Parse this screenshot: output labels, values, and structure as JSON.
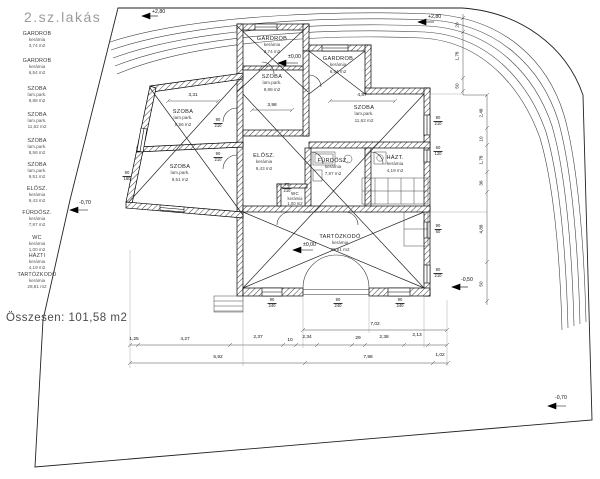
{
  "title": "2.sz.lakás",
  "total_label": "Összesen:  101,58 m2",
  "legend": [
    {
      "n": "GARDROB",
      "m": "kerámia",
      "a": "3,74  m2"
    },
    {
      "n": "GARDROB",
      "m": "kerámia",
      "a": "6,54  m2"
    },
    {
      "n": "SZOBA",
      "m": "lam.park.",
      "a": "9,88  m2"
    },
    {
      "n": "SZOBA",
      "m": "lam.park.",
      "a": "11,62  m2"
    },
    {
      "n": "SZOBA",
      "m": "lam.park.",
      "a": "8,56  m2"
    },
    {
      "n": "SZOBA",
      "m": "lam.park.",
      "a": "9,51  m2"
    },
    {
      "n": "ELŐSZ.",
      "m": "kerámia",
      "a": "9,43  m2"
    },
    {
      "n": "FÜRDŐSZ.",
      "m": "kerámia",
      "a": "7,87  m2"
    },
    {
      "n": "WC",
      "m": "kerámia",
      "a": "1,00  m2"
    },
    {
      "n": "HÁZTI",
      "m": "kerámia",
      "a": "4,19  m2"
    },
    {
      "n": "TARTÓZKODÓ",
      "m": "kerámia",
      "a": "28,81  m2"
    }
  ],
  "plan": {
    "hazt_n": "HÁZT."
  },
  "elevations": {
    "e280a": "+2,80",
    "e280b": "+2,80",
    "zero_a": "±0,00",
    "zero_b": "±0,00",
    "m050": "-0,50",
    "m070a": "-0,70",
    "m070b": "-0,70"
  },
  "dims": {
    "d331": "3,31",
    "d487": "4,87",
    "d398": "3,98",
    "d702": "7,02",
    "d125": "1,25",
    "d427": "4,27",
    "d237": "2,37",
    "d10a": "10",
    "d234": "2,34",
    "d29": "29",
    "d238": "2,38",
    "d213": "2,13",
    "d592": "5,92",
    "d798": "7,98",
    "d102": "1,02",
    "v20": "20",
    "v178a": "1,78",
    "v50a": "50",
    "v248": "2,48",
    "v10": "10",
    "v178b": "1,78",
    "v36": "36",
    "v488": "4,88",
    "v50b": "50"
  },
  "doors": [
    {
      "w": "90",
      "h": "210"
    },
    {
      "w": "90",
      "h": "210"
    },
    {
      "w": "75",
      "h": "210"
    },
    {
      "w": "90",
      "h": "210"
    },
    {
      "w": "60",
      "h": "120"
    },
    {
      "w": "90",
      "h": "60"
    },
    {
      "w": "90",
      "h": "210"
    },
    {
      "w": "90",
      "h": "240"
    },
    {
      "w": "90",
      "h": "240"
    },
    {
      "w": "90",
      "h": "240"
    },
    {
      "w": "90",
      "h": "180"
    }
  ]
}
